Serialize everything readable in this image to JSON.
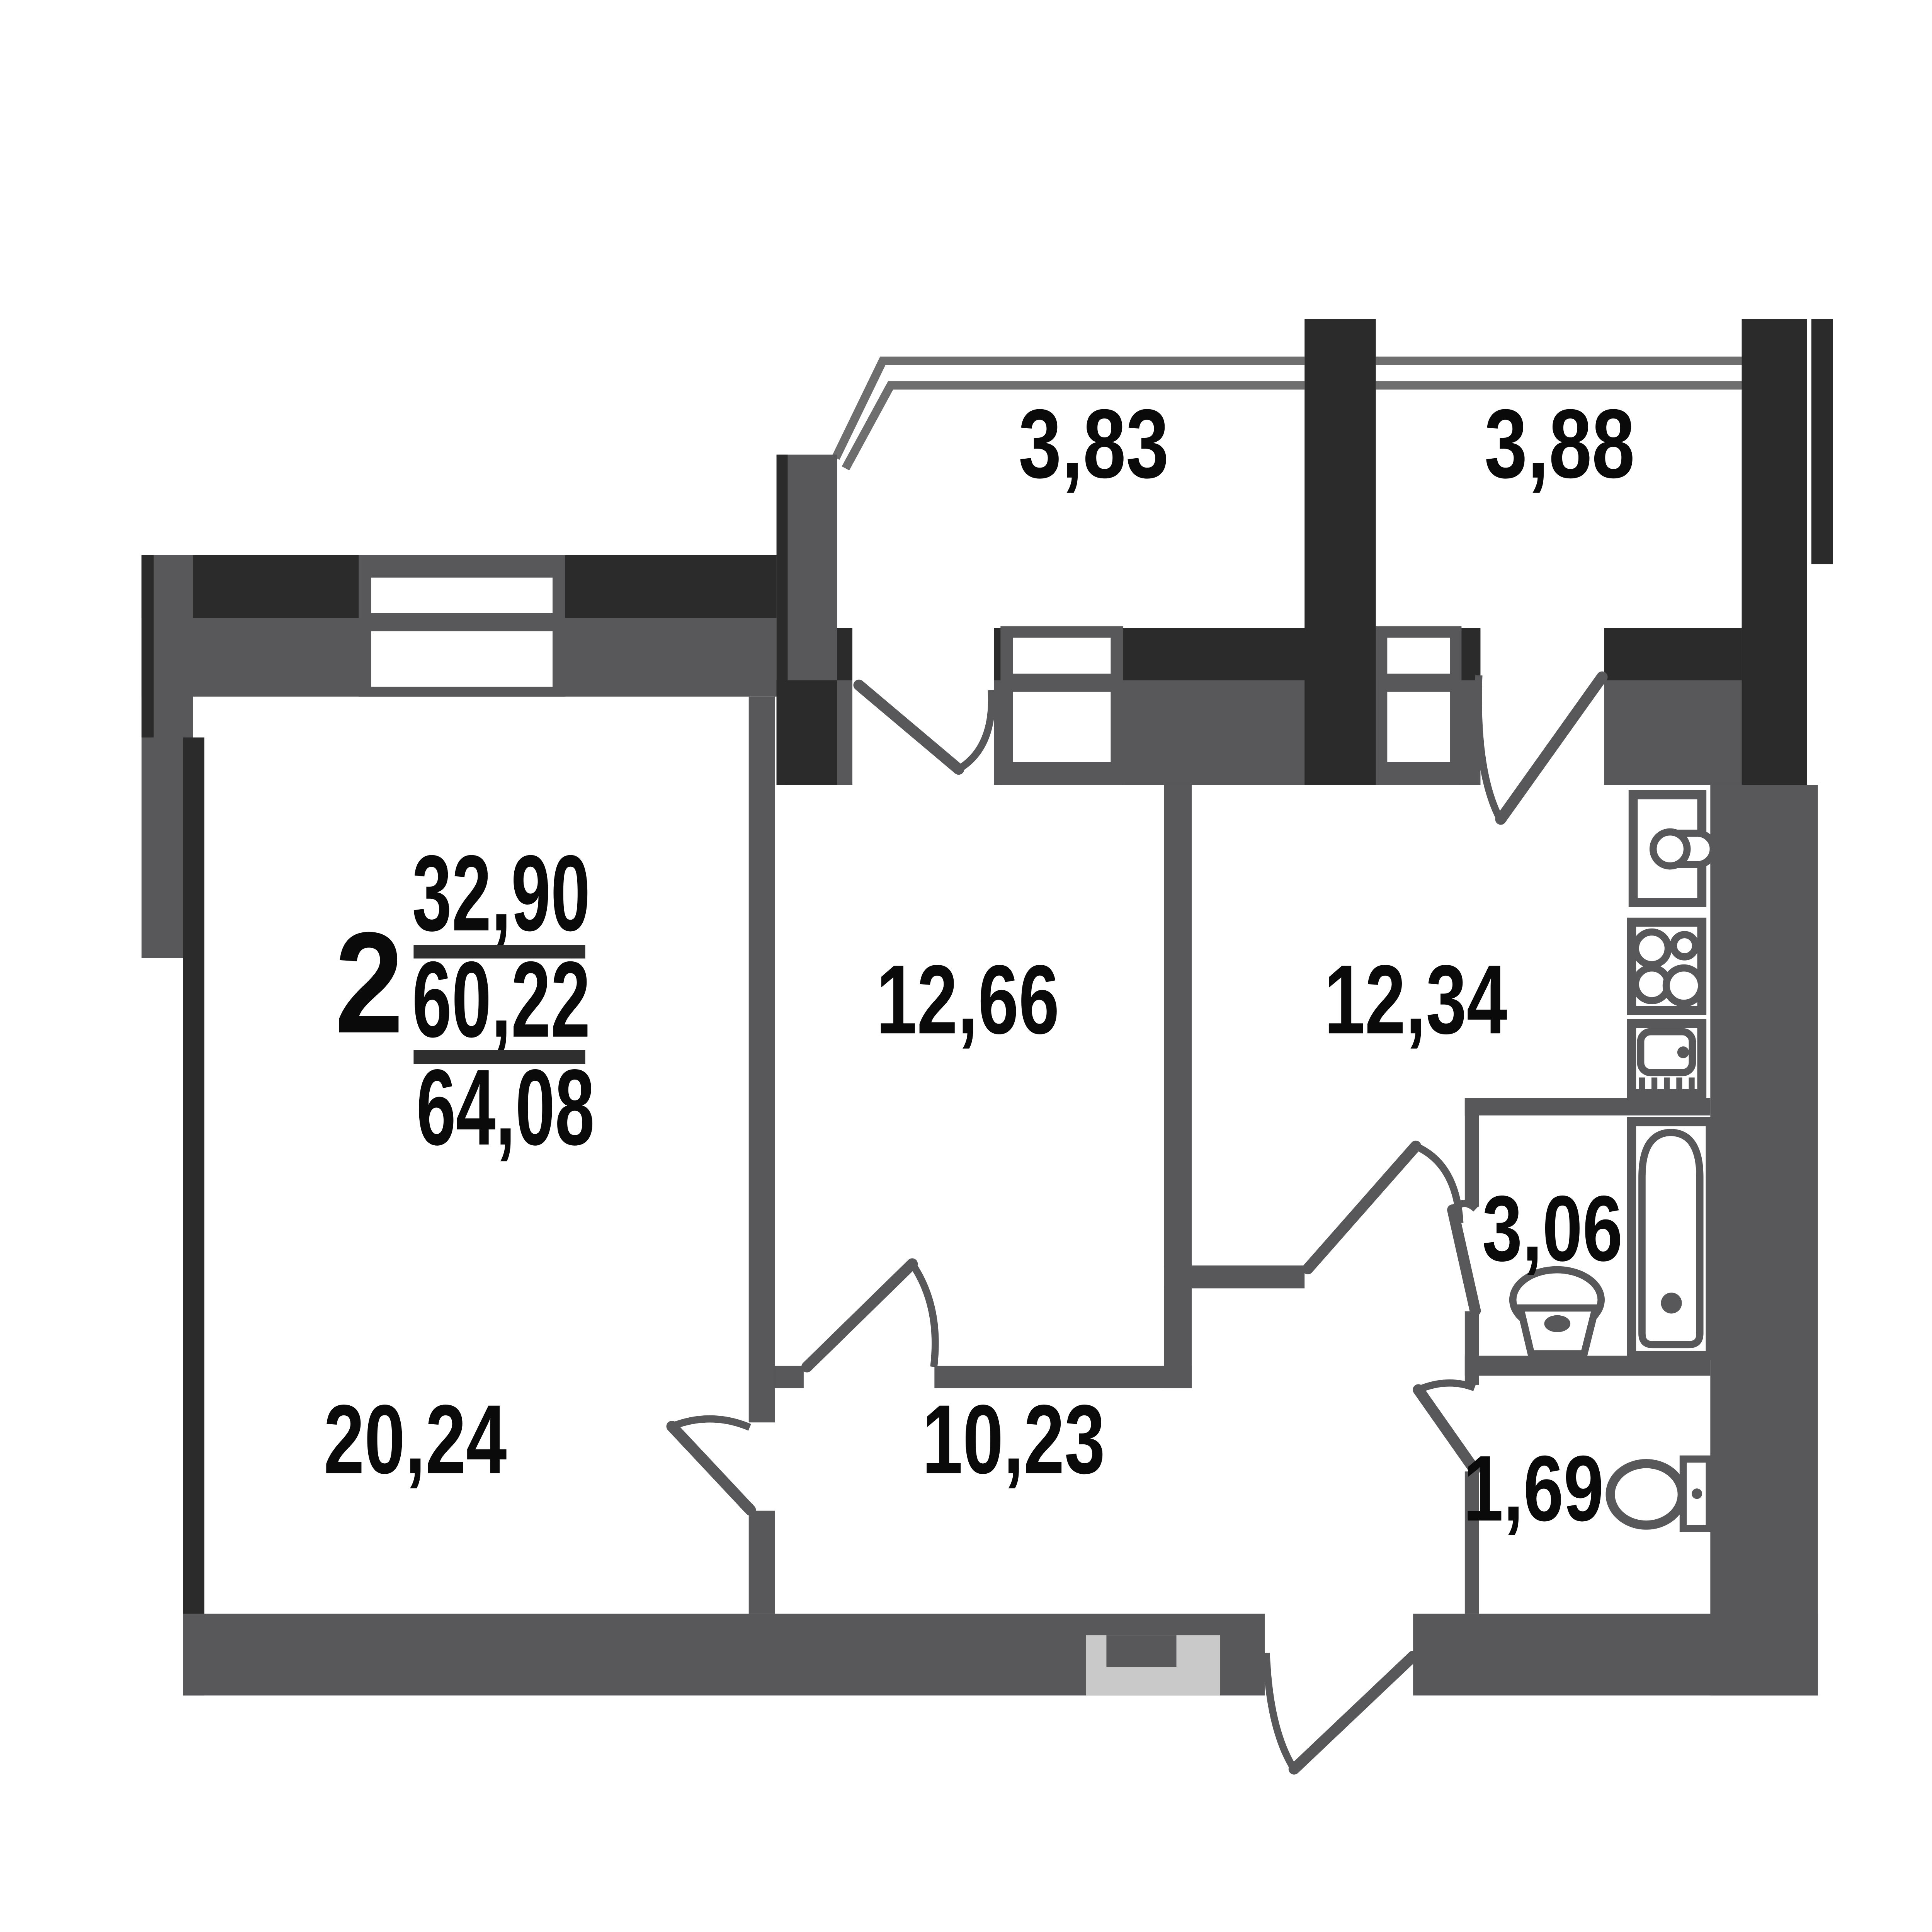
{
  "plan": {
    "kind": "apartment-floor-plan",
    "title_block": {
      "room_count": "2",
      "living_area": "32,90",
      "apartment_area": "60,22",
      "total_area": "64,08"
    },
    "room_labels": {
      "living_room": "20,24",
      "bedroom": "12,66",
      "kitchen": "12,34",
      "hallway": "10,23",
      "bathroom": "3,06",
      "toilet": "1,69",
      "balcony_left": "3,83",
      "balcony_right": "3,88"
    },
    "fixtures": [
      "kitchen-sink",
      "stove",
      "washing-machine",
      "bathtub",
      "wash-basin",
      "toilet-bowl"
    ],
    "colors": {
      "wall": "#58585a",
      "wall_dark": "#2b2b2b",
      "railing": "#6e6e6e",
      "entry_niche": "#c9c9c9",
      "label_text": "#0a0a0a",
      "background": "#ffffff"
    }
  }
}
